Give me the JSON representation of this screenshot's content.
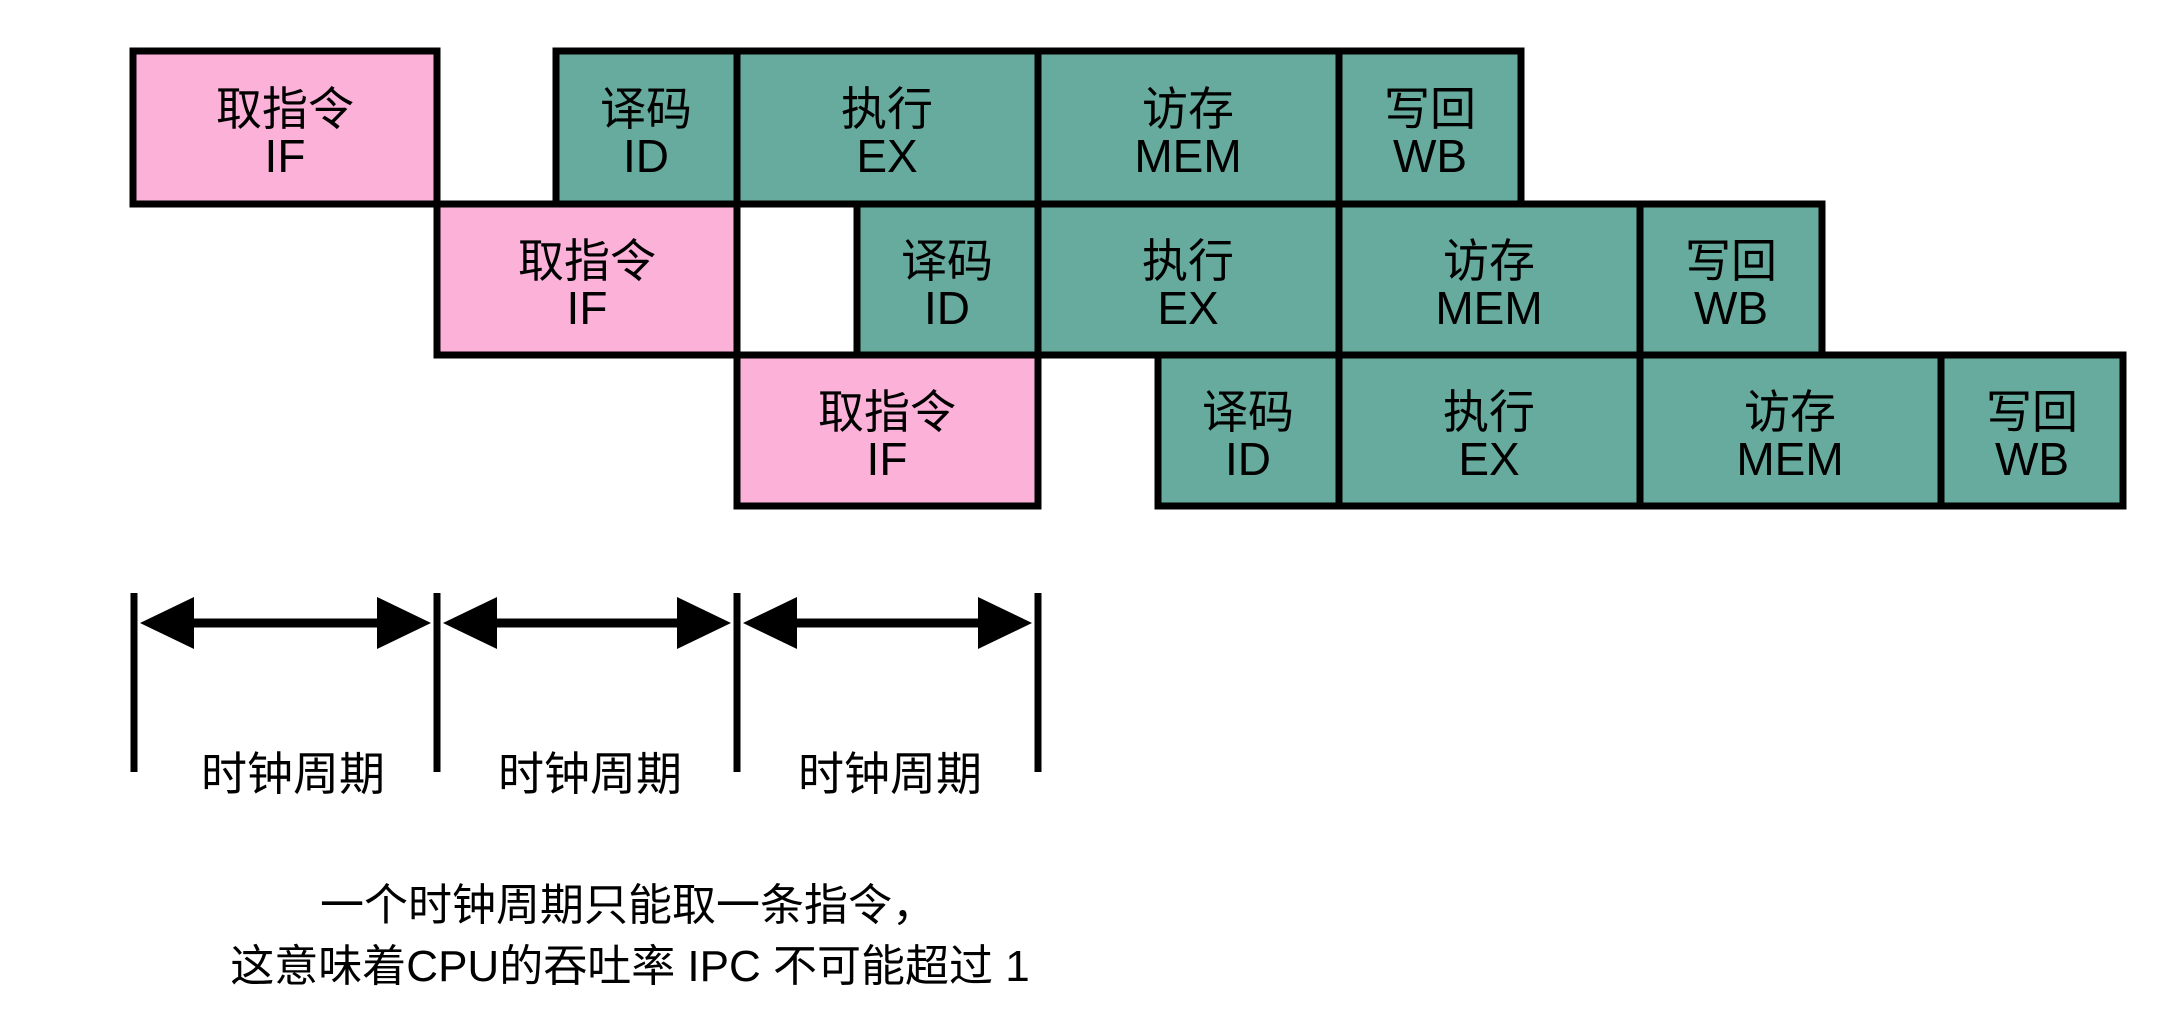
{
  "colors": {
    "fetch_fill": "#fbb1d8",
    "stage_fill": "#66ab9d",
    "line_color": "#000000"
  },
  "pipeline": {
    "rows": [
      {
        "name": "instruction-1",
        "stages": [
          {
            "zh": "取指令",
            "en": "IF"
          },
          {
            "zh": "译码",
            "en": "ID"
          },
          {
            "zh": "执行",
            "en": "EX"
          },
          {
            "zh": "访存",
            "en": "MEM"
          },
          {
            "zh": "写回",
            "en": "WB"
          }
        ]
      },
      {
        "name": "instruction-2",
        "stages": [
          {
            "zh": "取指令",
            "en": "IF"
          },
          {
            "zh": "译码",
            "en": "ID"
          },
          {
            "zh": "执行",
            "en": "EX"
          },
          {
            "zh": "访存",
            "en": "MEM"
          },
          {
            "zh": "写回",
            "en": "WB"
          }
        ]
      },
      {
        "name": "instruction-3",
        "stages": [
          {
            "zh": "取指令",
            "en": "IF"
          },
          {
            "zh": "译码",
            "en": "ID"
          },
          {
            "zh": "执行",
            "en": "EX"
          },
          {
            "zh": "访存",
            "en": "MEM"
          },
          {
            "zh": "写回",
            "en": "WB"
          }
        ]
      }
    ]
  },
  "timeline": {
    "labels": [
      "时钟周期",
      "时钟周期",
      "时钟周期"
    ]
  },
  "caption": {
    "line1": "一个时钟周期只能取一条指令，",
    "line2": "这意味着CPU的吞吐率 IPC 不可能超过 1"
  }
}
